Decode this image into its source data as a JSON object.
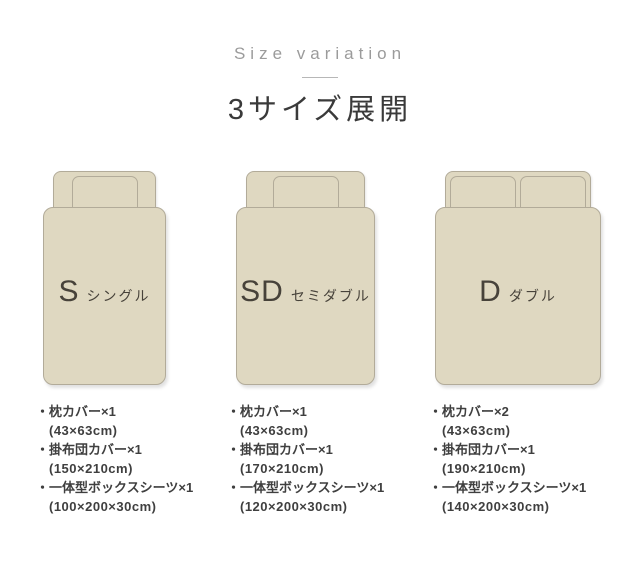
{
  "header": {
    "subtitle": "Size variation",
    "title": "3サイズ展開"
  },
  "colors": {
    "background": "#ffffff",
    "bed_fill": "#dfd8c1",
    "bed_border": "#b2ab99",
    "title_text": "#3a3a3a",
    "subtitle_text": "#9b9b9b",
    "list_text": "#3f3f3f"
  },
  "sizes": [
    {
      "code": "S",
      "name": "シングル",
      "pillow_count": 1,
      "items": [
        {
          "label": "・枕カバー×1",
          "size": "(43×63cm)"
        },
        {
          "label": "・掛布団カバー×1",
          "size": "(150×210cm)"
        },
        {
          "label": "・一体型ボックスシーツ×1",
          "size": "(100×200×30cm)"
        }
      ]
    },
    {
      "code": "SD",
      "name": "セミダブル",
      "pillow_count": 1,
      "items": [
        {
          "label": "・枕カバー×1",
          "size": "(43×63cm)"
        },
        {
          "label": "・掛布団カバー×1",
          "size": "(170×210cm)"
        },
        {
          "label": "・一体型ボックスシーツ×1",
          "size": "(120×200×30cm)"
        }
      ]
    },
    {
      "code": "D",
      "name": "ダブル",
      "pillow_count": 2,
      "items": [
        {
          "label": "・枕カバー×2",
          "size": "(43×63cm)"
        },
        {
          "label": "・掛布団カバー×1",
          "size": "(190×210cm)"
        },
        {
          "label": "・一体型ボックスシーツ×1",
          "size": "(140×200×30cm)"
        }
      ]
    }
  ]
}
